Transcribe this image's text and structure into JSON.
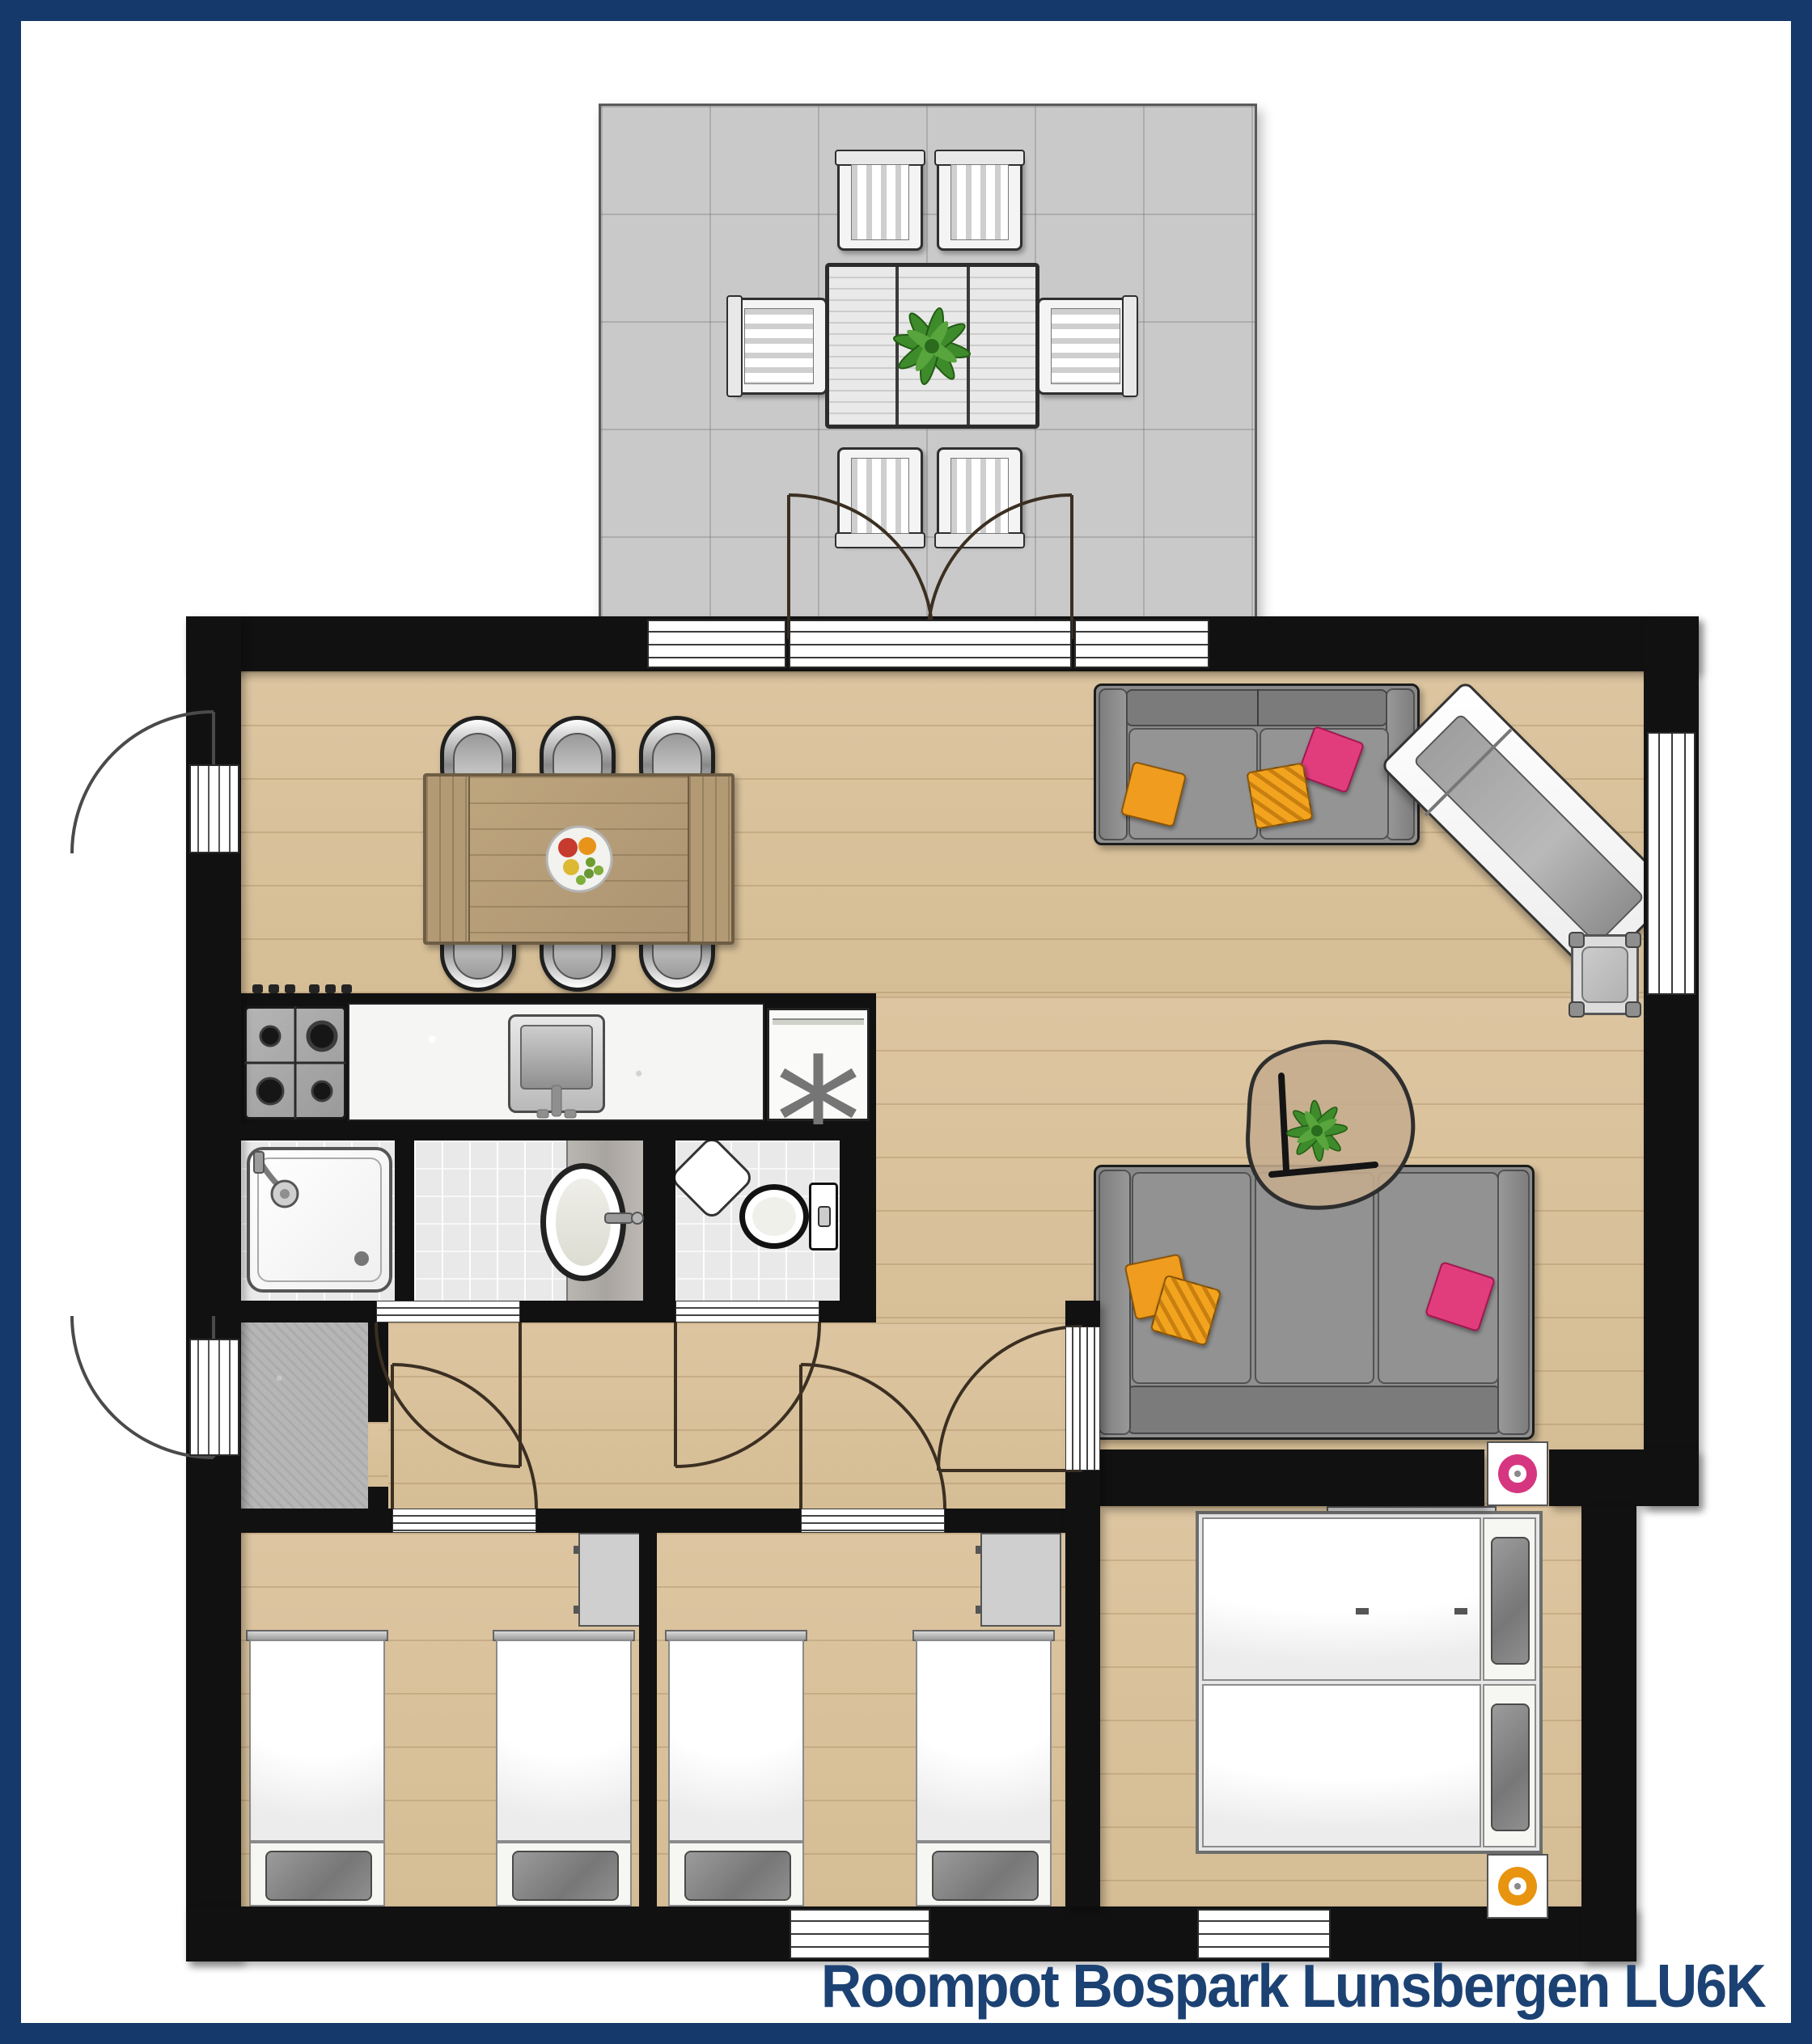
{
  "title": {
    "text": "Roompot Bospark Lunsbergen LU6K"
  },
  "appliances": {
    "freezer_symbol": "*"
  },
  "colors": {
    "navy": "#16396b",
    "titleNavy": "#1c4273",
    "wall": "#111111",
    "wood": "#d9c19c",
    "terrace": "#c9c9c9",
    "hallTile": "#b6b6b6",
    "sofaGray": "#8e8e8e",
    "pillowOrange": "#f09c1e",
    "pillowPink": "#e13d7d",
    "plantGreen": "#3e8b2b",
    "donutPink": "#d6367f",
    "donutOrange": "#e8940f"
  },
  "rooms": [
    {
      "id": "terrace",
      "floor": "gray-tiles"
    },
    {
      "id": "living-dining-kitchen",
      "floor": "wood"
    },
    {
      "id": "shower-room",
      "floor": "white-tiles"
    },
    {
      "id": "bathroom",
      "floor": "white-tiles"
    },
    {
      "id": "toilet-room",
      "floor": "white-tiles"
    },
    {
      "id": "entrance-hall",
      "floor": "gray-tiles"
    },
    {
      "id": "hallway",
      "floor": "wood"
    },
    {
      "id": "bedroom-1",
      "floor": "wood",
      "beds": 2
    },
    {
      "id": "bedroom-2",
      "floor": "wood",
      "beds": 2
    },
    {
      "id": "master-bedroom",
      "floor": "wood",
      "beds": 2
    }
  ],
  "furniture": [
    "outdoor-dining-table",
    "outdoor-chairs-x6",
    "potted-plant-x2",
    "dining-table",
    "dining-chairs-x6",
    "fruit-bowl",
    "kitchen-stove",
    "kitchen-sink",
    "freezer-unit",
    "sofa-2-seat",
    "sofa-3-seat",
    "sun-lounger",
    "side-stool",
    "coffee-table",
    "shower",
    "washbasin",
    "corner-basin",
    "toilet",
    "single-bed-x4",
    "double-bed",
    "wardrobe-x2",
    "desk",
    "nightstand-x2"
  ]
}
